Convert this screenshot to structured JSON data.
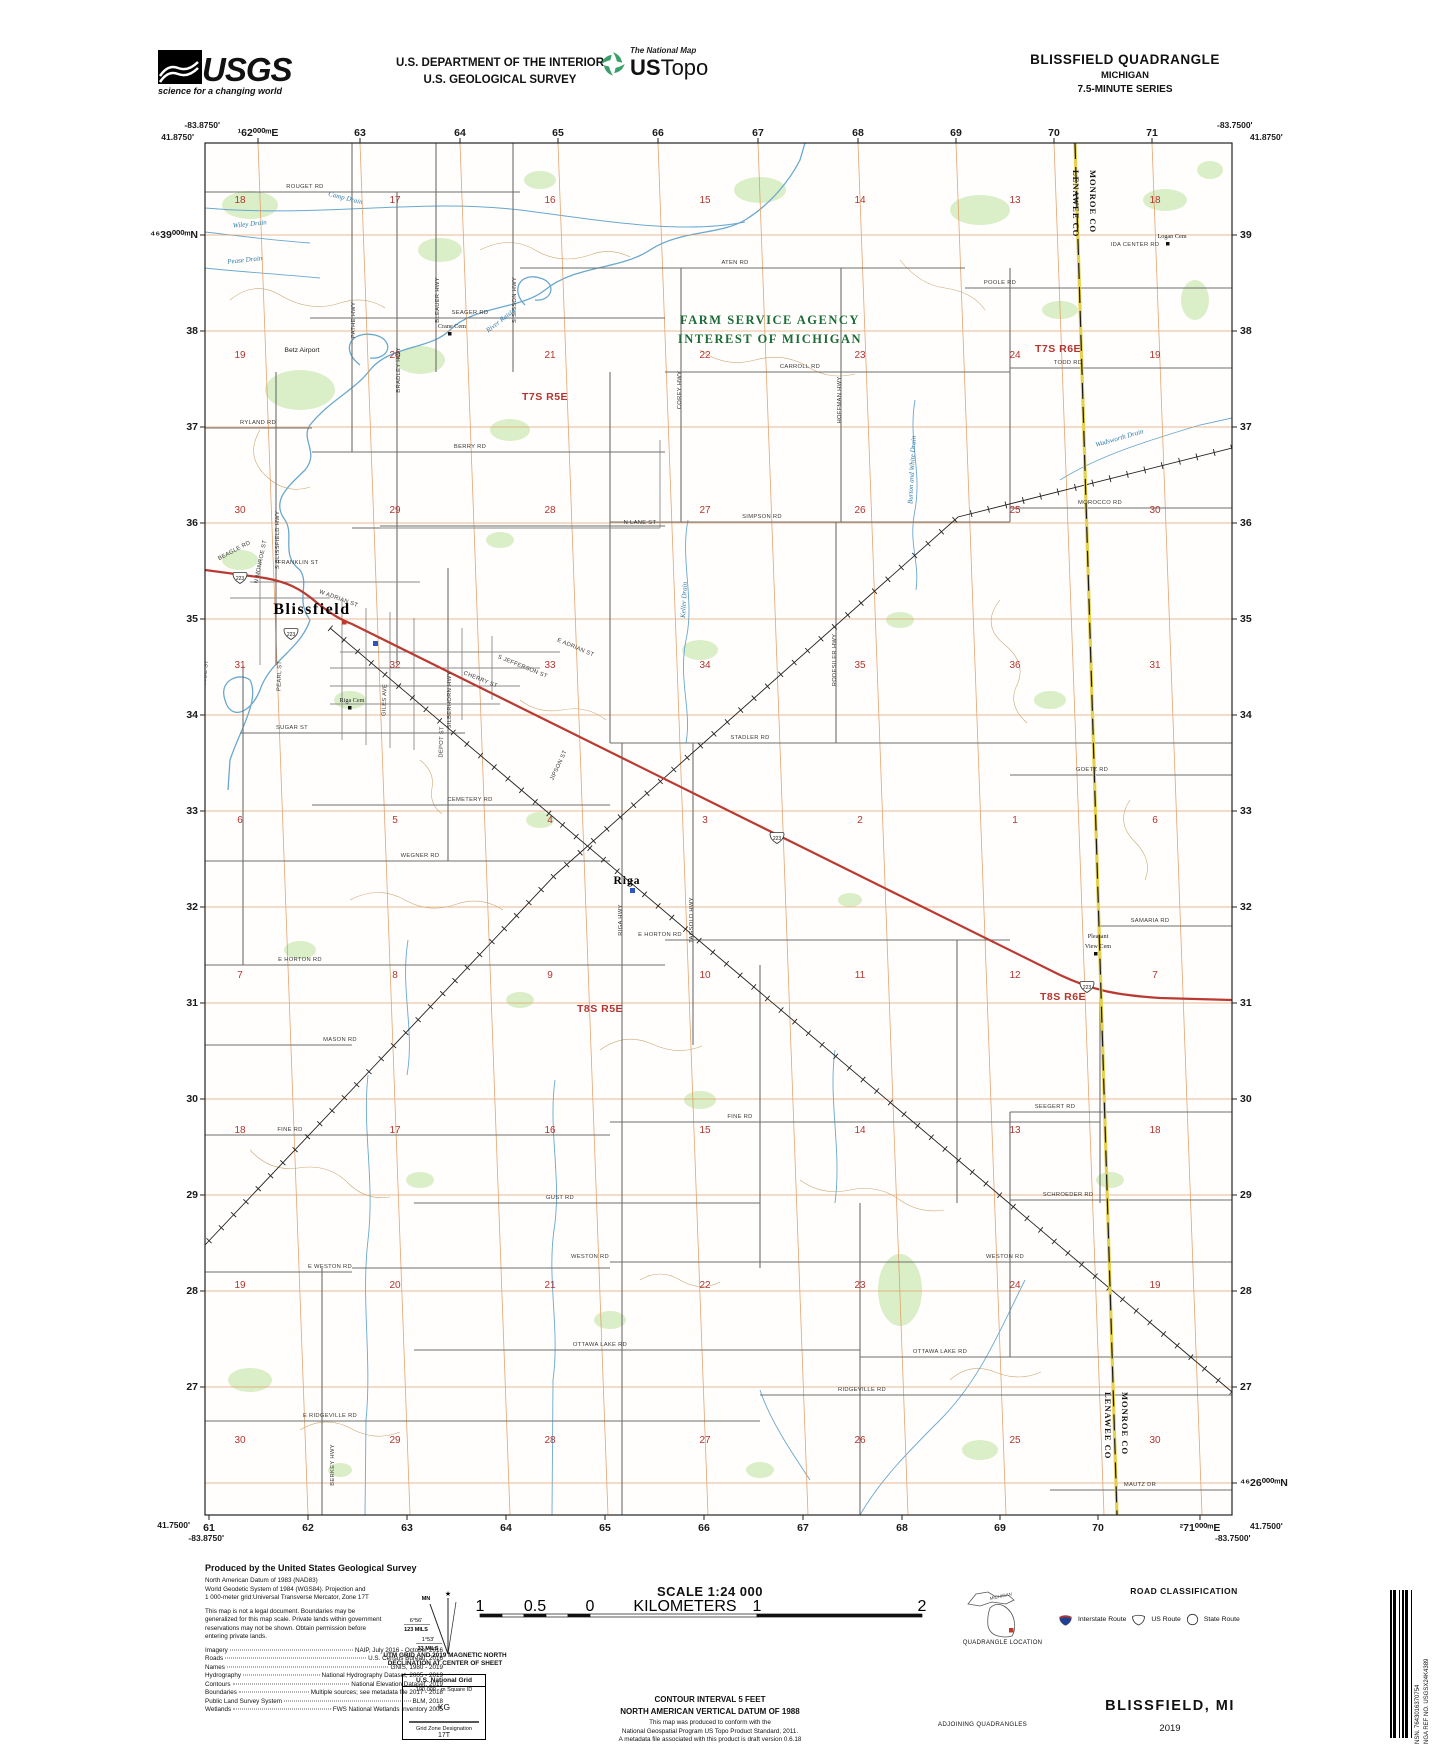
{
  "header": {
    "usgs": "USGS",
    "usgs_tagline": "science for a changing world",
    "dept_line1": "U.S. DEPARTMENT OF THE INTERIOR",
    "dept_line2": "U.S. GEOLOGICAL SURVEY",
    "natmap": "The National Map",
    "ustopo_us": "US",
    "ustopo_topo": "Topo",
    "quad_title": "BLISSFIELD QUADRANGLE",
    "quad_state": "MICHIGAN",
    "quad_series": "7.5-MINUTE SERIES"
  },
  "map": {
    "corners": [
      [
        "-83.8750'",
        220,
        128,
        "end"
      ],
      [
        "41.8750'",
        194,
        140,
        "end"
      ],
      [
        "-83.7500'",
        1217,
        128,
        "start"
      ],
      [
        "41.8750'",
        1250,
        140,
        "start"
      ],
      [
        "41.7500'",
        190,
        1528,
        "end"
      ],
      [
        "-83.8750'",
        224,
        1541,
        "end"
      ],
      [
        "41.7500'",
        1250,
        1529,
        "start"
      ],
      [
        "-83.7500'",
        1215,
        1541,
        "start"
      ]
    ],
    "top_edge": {
      "y": 136,
      "xs": [
        258,
        360,
        460,
        558,
        658,
        758,
        858,
        956,
        1054,
        1152
      ],
      "labels": [
        "¹62⁰⁰⁰ᵐE",
        "63",
        "64",
        "65",
        "66",
        "67",
        "68",
        "69",
        "70",
        "71"
      ]
    },
    "bottom_edge": {
      "y": 1531,
      "xs": [
        209,
        308,
        407,
        506,
        605,
        704,
        803,
        902,
        1000,
        1098,
        1200
      ],
      "labels": [
        "61",
        "62",
        "63",
        "64",
        "65",
        "66",
        "67",
        "68",
        "69",
        "70",
        "²71⁰⁰⁰ᵐE"
      ]
    },
    "left_edge": {
      "x": 198,
      "ys": [
        235,
        331,
        427,
        523,
        619,
        715,
        811,
        907,
        1003,
        1099,
        1195,
        1291,
        1387
      ],
      "labels": [
        "⁴⁶39⁰⁰⁰ᵐN",
        "38",
        "37",
        "36",
        "35",
        "34",
        "33",
        "32",
        "31",
        "30",
        "29",
        "28",
        "27"
      ]
    },
    "right_edge": {
      "x": 1240,
      "ys": [
        235,
        331,
        427,
        523,
        619,
        715,
        811,
        907,
        1003,
        1099,
        1195,
        1291,
        1387,
        1483
      ],
      "labels": [
        "39",
        "38",
        "37",
        "36",
        "35",
        "34",
        "33",
        "32",
        "31",
        "30",
        "29",
        "28",
        "27",
        "⁴⁶26⁰⁰⁰ᵐN"
      ]
    },
    "sections": {
      "cols": [
        240,
        395,
        550,
        705,
        860,
        1015,
        1155
      ],
      "rows": [
        {
          "y": 203,
          "nums": [
            "18",
            "17",
            "16",
            "15",
            "14",
            "13",
            "18"
          ]
        },
        {
          "y": 358,
          "nums": [
            "19",
            "20",
            "21",
            "22",
            "23",
            "24",
            "19"
          ]
        },
        {
          "y": 513,
          "nums": [
            "30",
            "29",
            "28",
            "27",
            "26",
            "25",
            "30"
          ]
        },
        {
          "y": 668,
          "nums": [
            "31",
            "32",
            "33",
            "34",
            "35",
            "36",
            "31"
          ]
        },
        {
          "y": 823,
          "nums": [
            "6",
            "5",
            "4",
            "3",
            "2",
            "1",
            "6"
          ]
        },
        {
          "y": 978,
          "nums": [
            "7",
            "8",
            "9",
            "10",
            "11",
            "12",
            "7"
          ]
        },
        {
          "y": 1133,
          "nums": [
            "18",
            "17",
            "16",
            "15",
            "14",
            "13",
            "18"
          ]
        },
        {
          "y": 1288,
          "nums": [
            "19",
            "20",
            "21",
            "22",
            "23",
            "24",
            "19"
          ]
        },
        {
          "y": 1443,
          "nums": [
            "30",
            "29",
            "28",
            "27",
            "26",
            "25",
            "30"
          ]
        }
      ]
    },
    "townships": [
      [
        "T7S R5E",
        545,
        400
      ],
      [
        "T7S R6E",
        1058,
        352
      ],
      [
        "T8S R5E",
        600,
        1012
      ],
      [
        "T8S R6E",
        1063,
        1000
      ]
    ],
    "towns": [
      [
        "Blissfield",
        312,
        614
      ],
      [
        "Riga",
        627,
        884
      ]
    ],
    "cemeteries": [
      [
        "Logan Cem",
        1172,
        238
      ],
      [
        "Crane Cem",
        452,
        328
      ],
      [
        "Riga Cem",
        352,
        702
      ],
      [
        "Pleasant",
        1098,
        938
      ],
      [
        "View Cem",
        1098,
        948
      ]
    ],
    "airport": [
      [
        "Betz Airport",
        302,
        352
      ]
    ],
    "farm": [
      [
        "FARM SERVICE AGENCY",
        770,
        324
      ],
      [
        "INTEREST OF MICHIGAN",
        770,
        343
      ]
    ],
    "county": [
      [
        "MONROE CO",
        1090,
        170
      ],
      [
        "LENAWEE CO",
        1073,
        170
      ],
      [
        "MONROE CO",
        1122,
        1392
      ],
      [
        "LENAWEE CO",
        1105,
        1392
      ]
    ],
    "roads": [
      [
        "ROUGET RD",
        305,
        188,
        0
      ],
      [
        "ATEN RD",
        735,
        264,
        0
      ],
      [
        "POOLE RD",
        1000,
        284,
        0
      ],
      [
        "TODD RD",
        1068,
        364,
        0
      ],
      [
        "CARROLL RD",
        800,
        368,
        0
      ],
      [
        "SEAGER RD",
        470,
        314,
        0
      ],
      [
        "BERRY RD",
        470,
        448,
        0
      ],
      [
        "RYLAND RD",
        258,
        424,
        0
      ],
      [
        "MOROCCO RD",
        1100,
        504,
        0
      ],
      [
        "SIMPSON RD",
        762,
        518,
        0
      ],
      [
        "N LANE ST",
        640,
        524,
        0
      ],
      [
        "BEAGLE RD",
        235,
        552,
        -28
      ],
      [
        "FRANKLIN ST",
        298,
        564,
        0
      ],
      [
        "W ADRIAN ST",
        338,
        600,
        20
      ],
      [
        "E ADRIAN ST",
        575,
        649,
        23
      ],
      [
        "SUGAR ST",
        292,
        729,
        0
      ],
      [
        "STADLER RD",
        750,
        739,
        0
      ],
      [
        "GOETZ RD",
        1092,
        771,
        0
      ],
      [
        "CEMETERY RD",
        470,
        801,
        0
      ],
      [
        "WEGNER RD",
        420,
        857,
        0
      ],
      [
        "E HORTON RD",
        660,
        936,
        0
      ],
      [
        "E HORTON RD",
        300,
        961,
        0
      ],
      [
        "MASON RD",
        340,
        1041,
        0
      ],
      [
        "SAMARIA RD",
        1150,
        922,
        0
      ],
      [
        "FINE RD",
        290,
        1131,
        0
      ],
      [
        "FINE RD",
        740,
        1118,
        0
      ],
      [
        "SEEGERT RD",
        1055,
        1108,
        0
      ],
      [
        "GUST RD",
        560,
        1199,
        0
      ],
      [
        "SCHROEDER RD",
        1068,
        1196,
        0
      ],
      [
        "E WESTON RD",
        330,
        1268,
        0
      ],
      [
        "WESTON RD",
        590,
        1258,
        0
      ],
      [
        "WESTON RD",
        1005,
        1258,
        0
      ],
      [
        "OTTAWA LAKE RD",
        600,
        1346,
        0
      ],
      [
        "OTTAWA LAKE RD",
        940,
        1353,
        0
      ],
      [
        "RIDGEVILLE RD",
        862,
        1391,
        0
      ],
      [
        "E RIDGEVILLE RD",
        330,
        1417,
        0
      ],
      [
        "MAUTZ DR",
        1140,
        1486,
        0
      ],
      [
        "IDA CENTER RD",
        1135,
        246,
        0
      ],
      [
        "PATHE HWY",
        355,
        320,
        -90
      ],
      [
        "BLEAUER HWY",
        439,
        300,
        -90
      ],
      [
        "S SISSON HWY",
        516,
        300,
        -90
      ],
      [
        "COREY HWY",
        681,
        390,
        -90
      ],
      [
        "HOFFMAN HWY",
        841,
        400,
        -90
      ],
      [
        "RODESILER HWY",
        836,
        660,
        -90
      ],
      [
        "SILBERHORN HWY",
        451,
        700,
        -90
      ],
      [
        "S BLISSFIELD HWY",
        279,
        540,
        -90
      ],
      [
        "BRADLEY HWY",
        400,
        370,
        -90
      ],
      [
        "RIGA HWY",
        622,
        920,
        -90
      ],
      [
        "TAGSOLD HWY",
        693,
        920,
        -90
      ],
      [
        "BERKEY HWY",
        334,
        1465,
        -90
      ],
      [
        "N MONROE ST",
        262,
        562,
        -78
      ],
      [
        "S MONROE ST",
        206,
        682,
        -85
      ],
      [
        "PEARL ST",
        281,
        676,
        -88
      ],
      [
        "GILES AVE",
        386,
        700,
        -88
      ],
      [
        "DEPOT ST",
        443,
        742,
        -88
      ],
      [
        "S JEFFERSON ST",
        522,
        668,
        22
      ],
      [
        "CHERRY ST",
        480,
        681,
        22
      ],
      [
        "JIPSON ST",
        560,
        766,
        -65
      ]
    ],
    "drains": [
      [
        "Camp Drain",
        345,
        200,
        14
      ],
      [
        "Wiley Drain",
        250,
        226,
        -6
      ],
      [
        "Pease Drain",
        245,
        262,
        -6
      ],
      [
        "River Raisin",
        502,
        322,
        -38
      ],
      [
        "Keller Drain",
        686,
        600,
        -87
      ],
      [
        "Burton and White Drain",
        914,
        470,
        -87
      ],
      [
        "Wadsworth Drain",
        1120,
        440,
        -16
      ]
    ],
    "route_shields": {
      "text": "223",
      "points": [
        [
          240,
          578
        ],
        [
          291,
          634
        ],
        [
          777,
          838
        ],
        [
          1087,
          987
        ]
      ]
    }
  },
  "footer": {
    "credits": {
      "title": "Produced by the United States Geological Survey",
      "datum": [
        "North American Datum of 1983 (NAD83)",
        "World Geodetic System of 1984 (WGS84).  Projection and",
        "1 000-meter grid:Universal Transverse Mercator, Zone 17T"
      ],
      "legal": [
        "This map is not a legal document. Boundaries may be",
        "generalized for this map scale. Private lands within government",
        "reservations may not be shown. Obtain permission before",
        "entering private lands."
      ],
      "sources": [
        [
          "Imagery",
          "NAIP, July 2016 - October 2016"
        ],
        [
          "Roads",
          "U.S. Census Bureau, 2016"
        ],
        [
          "Names",
          "GNIS, 1980 - 2019"
        ],
        [
          "Hydrography",
          "National Hydrography Dataset, 2005 - 2019"
        ],
        [
          "Contours",
          "National Elevation Dataset, 2019"
        ],
        [
          "Boundaries",
          "Multiple sources; see metadata file 2017 - 2018"
        ],
        [
          "Public Land Survey System",
          "BLM, 2018"
        ],
        [
          "Wetlands",
          "FWS National Wetlands Inventory 2005"
        ]
      ]
    },
    "declination": {
      "mn": "MN",
      "star": "★",
      "deg1": "6°56'",
      "mils1": "123 MILS",
      "deg2": "1°53'",
      "mils2": "33 MILS",
      "caption1": "UTM GRID AND 2019 MAGNETIC NORTH",
      "caption2": "DECLINATION AT CENTER OF SHEET"
    },
    "usng": {
      "title": "U.S. National Grid",
      "sub": "100,000 - m Square ID",
      "square": "KG",
      "zone_label": "Grid Zone Designation",
      "zone": "17T"
    },
    "scale": {
      "title": "SCALE 1:24 000",
      "rows": [
        {
          "labels": [
            [
              "1",
              10
            ],
            [
              "0.5",
              65
            ],
            [
              "0",
              120
            ],
            [
              "KILOMETERS",
              215
            ],
            [
              "1",
              287
            ],
            [
              "2",
              452
            ]
          ]
        },
        {
          "labels": [
            [
              "1000",
              10
            ],
            [
              "500",
              65
            ],
            [
              "0",
              120
            ],
            [
              "METERS",
              215
            ],
            [
              "1000",
              287
            ],
            [
              "2000",
              452
            ]
          ]
        },
        {
          "labels": [
            [
              "1",
              10
            ],
            [
              "0.5",
              126
            ],
            [
              "0",
              243
            ],
            [
              "1",
              452
            ]
          ],
          "unit": "MILES",
          "unit_x": 230
        },
        {
          "labels": [
            [
              "1000",
              10
            ],
            [
              "0",
              46
            ],
            [
              "1000",
              83
            ],
            [
              "2000",
              119
            ],
            [
              "3000",
              155
            ],
            [
              "4000",
              192
            ],
            [
              "5000",
              228
            ],
            [
              "6000",
              264
            ],
            [
              "7000",
              301
            ],
            [
              "8000",
              337
            ],
            [
              "9000",
              373
            ],
            [
              "10000",
              410
            ]
          ],
          "unit": "FEET",
          "unit_x": 210
        }
      ]
    },
    "contour1": "CONTOUR INTERVAL 5 FEET",
    "contour2": "NORTH AMERICAN VERTICAL DATUM OF 1988",
    "conformance": [
      "This map was produced to conform with the",
      "National Geospatial Program US Topo Product Standard, 2011.",
      "A metadata file associated with this product is draft version 0.6.18"
    ],
    "quadloc": {
      "state": "MICHIGAN",
      "caption": "QUADRANGLE LOCATION"
    },
    "adjoining": {
      "cells": [
        "1",
        "2",
        "3",
        "4",
        "5",
        "6",
        "7",
        "8"
      ],
      "names": [
        "1 Tecumseh South",
        "2 Deerfield",
        "3 Dundee",
        "4 Palmyra",
        "5 Lambertville West",
        "6 Assumption",
        "7 Berkey",
        "8 Sylvania"
      ],
      "caption": "ADJOINING QUADRANGLES"
    },
    "roadclass": {
      "title": "ROAD CLASSIFICATION",
      "left": [
        "Expressway",
        "Secondary Hwy",
        "Ramp"
      ],
      "right": [
        "Local Connector",
        "Local Road",
        "4WD"
      ],
      "shields": [
        "Interstate Route",
        "US Route",
        "State Route"
      ]
    },
    "titleblock": {
      "name": "BLISSFIELD, MI",
      "year": "2019"
    },
    "barcode": {
      "nsn": "NSN. 7643016370754",
      "nga": "NGA REF NO. USGSX24K4389"
    }
  }
}
